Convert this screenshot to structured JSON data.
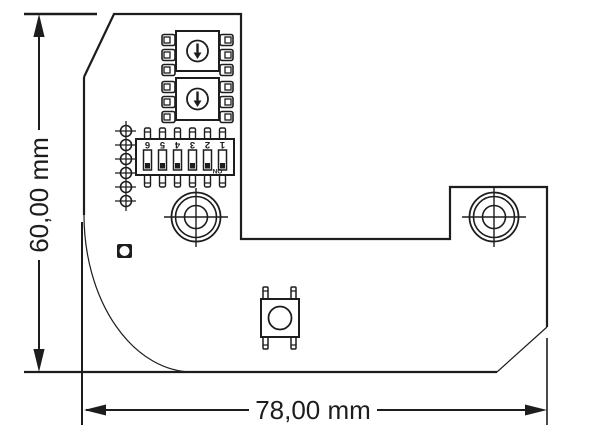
{
  "drawing": {
    "kind": "pcb-outline-dimension-drawing",
    "background_color": "#ffffff",
    "line_color": "#1d1d1d",
    "dimensions": {
      "height": {
        "label": "60,00 mm"
      },
      "width": {
        "label": "78,00 mm"
      }
    },
    "dip_switch": {
      "positions": 6,
      "labels": [
        "6",
        "5",
        "4",
        "3",
        "2",
        "1"
      ],
      "on_label": "ON",
      "orientation": "rotated-180"
    },
    "components": [
      "rotary-switch",
      "rotary-switch",
      "dip-switch-6pos",
      "solder-pad-column-6",
      "mounting-hole",
      "mounting-hole",
      "push-button",
      "led-indicator"
    ]
  }
}
